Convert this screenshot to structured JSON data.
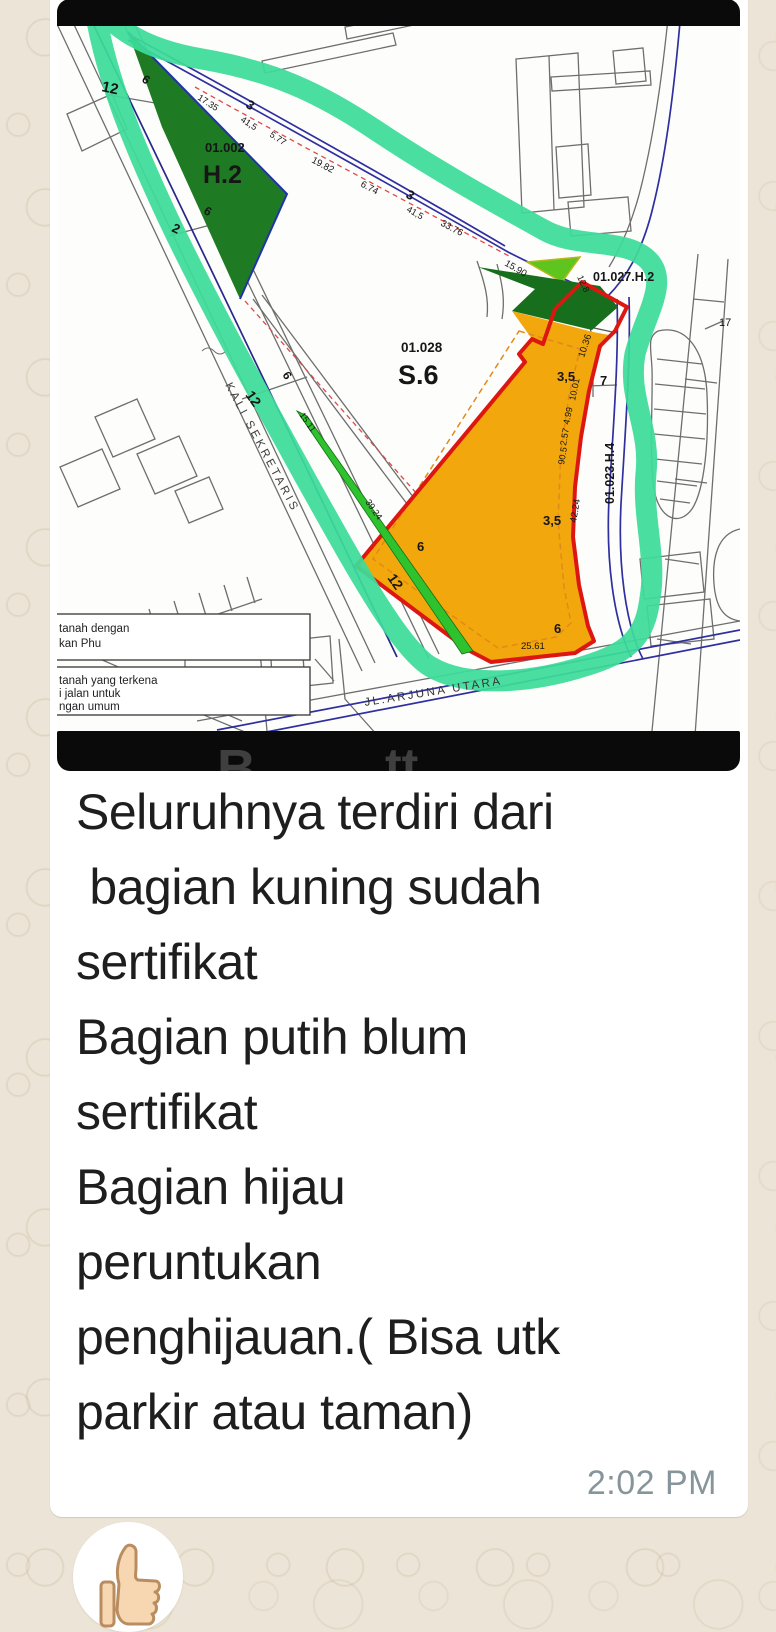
{
  "chat": {
    "message": {
      "caption": "Seluruhnya terdiri dari\n bagian kuning sudah\nsertifikat\nBagian putih blum\nsertifikat\nBagian hijau\nperuntukan\npenghijauan.( Bisa utk\nparkir atau taman)",
      "time": "2:02 PM"
    },
    "sticker": {
      "icon": "thumbs-up"
    }
  },
  "map": {
    "colors": {
      "marker_outline": "#3cdd99",
      "certified_yellow": "#f2a70c",
      "boundary_red": "#dd1611",
      "dark_green": "#1e7b23",
      "bright_green": "#2ec22e",
      "lime_green": "#5dc51d",
      "road_blue": "#2f2fa0"
    },
    "labels": [
      {
        "t": "01.002",
        "x": 148,
        "y": 153,
        "s": 13,
        "b": 1
      },
      {
        "t": "H.2",
        "x": 146,
        "y": 184,
        "s": 25,
        "b": 1
      },
      {
        "t": "12",
        "x": 44,
        "y": 92,
        "s": 15,
        "r": 12,
        "b": 1
      },
      {
        "t": "6",
        "x": 84,
        "y": 82,
        "s": 12,
        "r": 35,
        "b": 1
      },
      {
        "t": "17.35",
        "x": 140,
        "y": 100,
        "s": 9,
        "r": 33
      },
      {
        "t": "3",
        "x": 188,
        "y": 108,
        "s": 13,
        "r": 30,
        "b": 1
      },
      {
        "t": "41,5",
        "x": 183,
        "y": 122,
        "s": 9,
        "r": 33
      },
      {
        "t": "5.77",
        "x": 212,
        "y": 137,
        "s": 9,
        "r": 33
      },
      {
        "t": "2",
        "x": 114,
        "y": 232,
        "s": 13,
        "r": 25,
        "b": 1
      },
      {
        "t": "6",
        "x": 146,
        "y": 214,
        "s": 12,
        "r": 30,
        "b": 1
      },
      {
        "t": "19.82",
        "x": 254,
        "y": 163,
        "s": 9.5,
        "r": 28
      },
      {
        "t": "6.74",
        "x": 303,
        "y": 187,
        "s": 9.5,
        "r": 28
      },
      {
        "t": "3",
        "x": 348,
        "y": 198,
        "s": 13,
        "r": 30,
        "b": 1
      },
      {
        "t": "41,5",
        "x": 349,
        "y": 212,
        "s": 9,
        "r": 30
      },
      {
        "t": "33.76",
        "x": 383,
        "y": 226,
        "s": 9.5,
        "r": 28
      },
      {
        "t": "15.90",
        "x": 447,
        "y": 266,
        "s": 9.5,
        "r": 30
      },
      {
        "t": "12.8",
        "x": 520,
        "y": 278,
        "s": 9,
        "r": 65
      },
      {
        "t": "01.027.H.2",
        "x": 536,
        "y": 282,
        "s": 12.5,
        "b": 1
      },
      {
        "t": "17",
        "x": 662,
        "y": 327,
        "s": 11
      },
      {
        "t": "01.028",
        "x": 344,
        "y": 353,
        "s": 13.5,
        "b": 1
      },
      {
        "t": "S.6",
        "x": 341,
        "y": 385,
        "s": 27,
        "b": 1
      },
      {
        "t": "12",
        "x": 188,
        "y": 396,
        "s": 14,
        "r": 55,
        "b": 1
      },
      {
        "t": "6",
        "x": 225,
        "y": 376,
        "s": 12,
        "r": 55,
        "b": 1
      },
      {
        "t": "15.11",
        "x": 242,
        "y": 416,
        "s": 9,
        "r": 55
      },
      {
        "t": "39.24",
        "x": 308,
        "y": 503,
        "s": 9,
        "r": 55
      },
      {
        "t": "12",
        "x": 330,
        "y": 579,
        "s": 14,
        "r": 55,
        "b": 1
      },
      {
        "t": "6",
        "x": 360,
        "y": 552,
        "s": 13,
        "b": 1
      },
      {
        "t": "10.36",
        "x": 527,
        "y": 359,
        "s": 9.5,
        "r": -72
      },
      {
        "t": "3,5",
        "x": 500,
        "y": 382,
        "s": 13,
        "b": 1
      },
      {
        "t": "7",
        "x": 543,
        "y": 386,
        "s": 13,
        "b": 1
      },
      {
        "t": "10.01",
        "x": 518,
        "y": 402,
        "s": 9,
        "r": -78
      },
      {
        "t": "4.99",
        "x": 512,
        "y": 426,
        "s": 9,
        "r": -78
      },
      {
        "t": "2.57",
        "x": 509,
        "y": 447,
        "s": 9,
        "r": -80
      },
      {
        "t": "90.5",
        "x": 507,
        "y": 466,
        "s": 9,
        "r": -80
      },
      {
        "t": "42.24",
        "x": 519,
        "y": 524,
        "s": 9.5,
        "r": -80
      },
      {
        "t": "3,5",
        "x": 486,
        "y": 526,
        "s": 13,
        "b": 1
      },
      {
        "t": "01.023.H.4",
        "x": 557,
        "y": 505,
        "s": 12.5,
        "r": -90,
        "b": 1
      },
      {
        "t": "6",
        "x": 497,
        "y": 634,
        "s": 13,
        "b": 1
      },
      {
        "t": "25.61",
        "x": 464,
        "y": 650,
        "s": 9.5
      },
      {
        "t": "KALI SEKRETARIS",
        "x": 168,
        "y": 386,
        "s": 11.5,
        "r": 62,
        "ls": 3,
        "c": "#3d3d3d"
      },
      {
        "t": "JL.ARJUNA UTARA",
        "x": 308,
        "y": 707,
        "s": 11.5,
        "r": -9,
        "ls": 2.5,
        "c": "#333333"
      },
      {
        "t": "tanah dengan",
        "x": 2,
        "y": 633,
        "s": 11.5,
        "c": "#222222"
      },
      {
        "t": "kan Phu",
        "x": 2,
        "y": 648,
        "s": 11.5,
        "c": "#222222"
      },
      {
        "t": "tanah yang terkena",
        "x": 2,
        "y": 685,
        "s": 11.5,
        "c": "#222222"
      },
      {
        "t": "i jalan untuk",
        "x": 2,
        "y": 698,
        "s": 11.5,
        "c": "#222222"
      },
      {
        "t": "ngan umum",
        "x": 2,
        "y": 711,
        "s": 11.5,
        "c": "#222222"
      },
      {
        "t": "B",
        "x": 160,
        "y": 788,
        "s": 54,
        "b": 1,
        "c": "#3f3f3f"
      },
      {
        "t": "tt",
        "x": 328,
        "y": 784,
        "s": 50,
        "b": 1,
        "c": "#3f3f3f"
      }
    ]
  }
}
